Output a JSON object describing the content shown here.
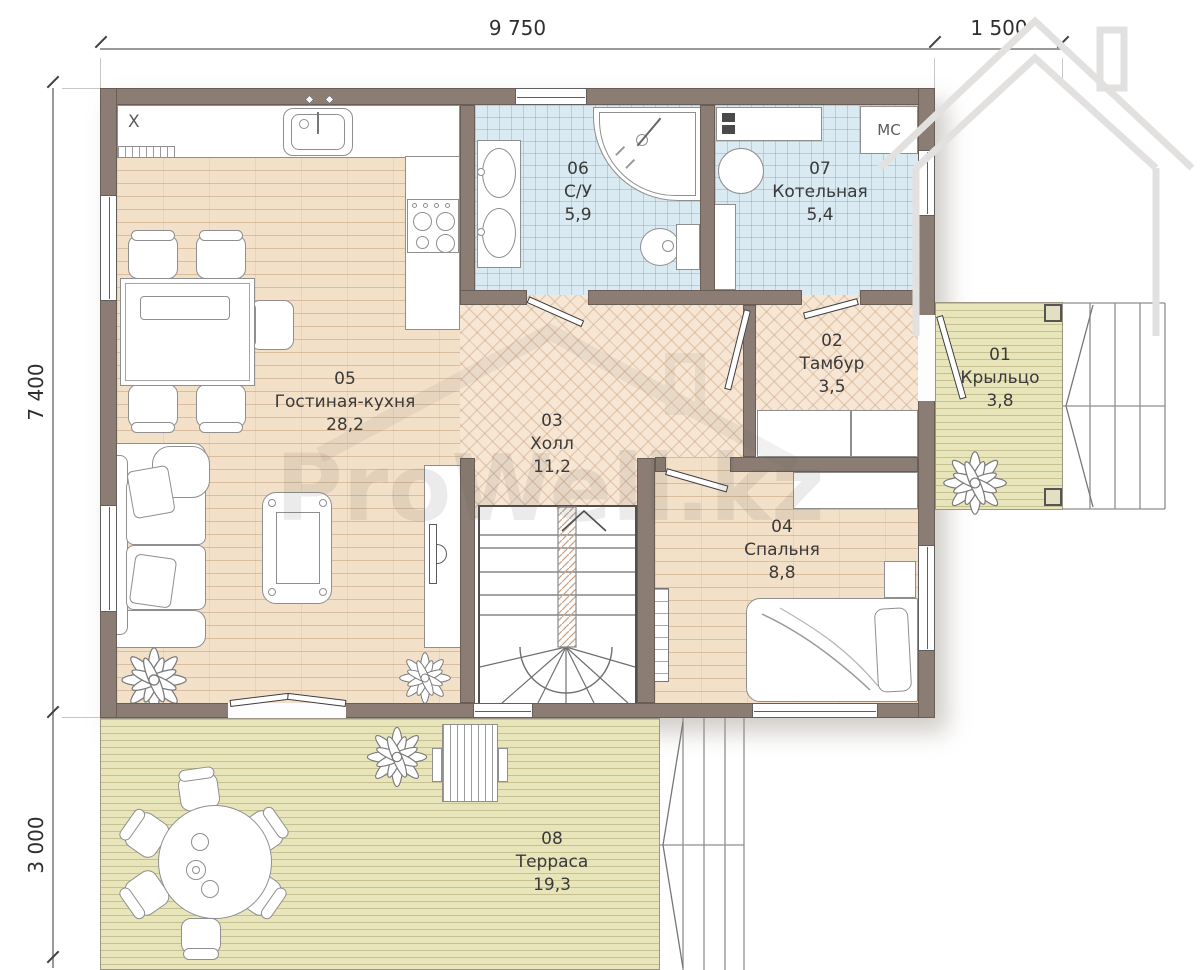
{
  "dimensions": {
    "top_width": "9 750",
    "porch_width": "1 500",
    "left_height": "7 400",
    "terrace_depth": "3 000"
  },
  "rooms": [
    {
      "number": "01",
      "name": "Крыльцо",
      "area": "3,8"
    },
    {
      "number": "02",
      "name": "Тамбур",
      "area": "3,5"
    },
    {
      "number": "03",
      "name": "Холл",
      "area": "11,2"
    },
    {
      "number": "04",
      "name": "Спальня",
      "area": "8,8"
    },
    {
      "number": "05",
      "name": "Гостиная-кухня",
      "area": "28,2"
    },
    {
      "number": "06",
      "name": "С/У",
      "area": "5,9"
    },
    {
      "number": "07",
      "name": "Котельная",
      "area": "5,4"
    },
    {
      "number": "08",
      "name": "Терраса",
      "area": "19,3"
    }
  ],
  "markers": {
    "boiler_unit": "МС",
    "kitchen_x": "X"
  },
  "watermark": {
    "text": "ProWell.kz"
  },
  "colors": {
    "wall": "#8b7d73",
    "tile": "#d9eaf2",
    "wood": "#f3e0c8",
    "herringbone": "#f7e6d3",
    "deck": "#e9e5ba"
  }
}
